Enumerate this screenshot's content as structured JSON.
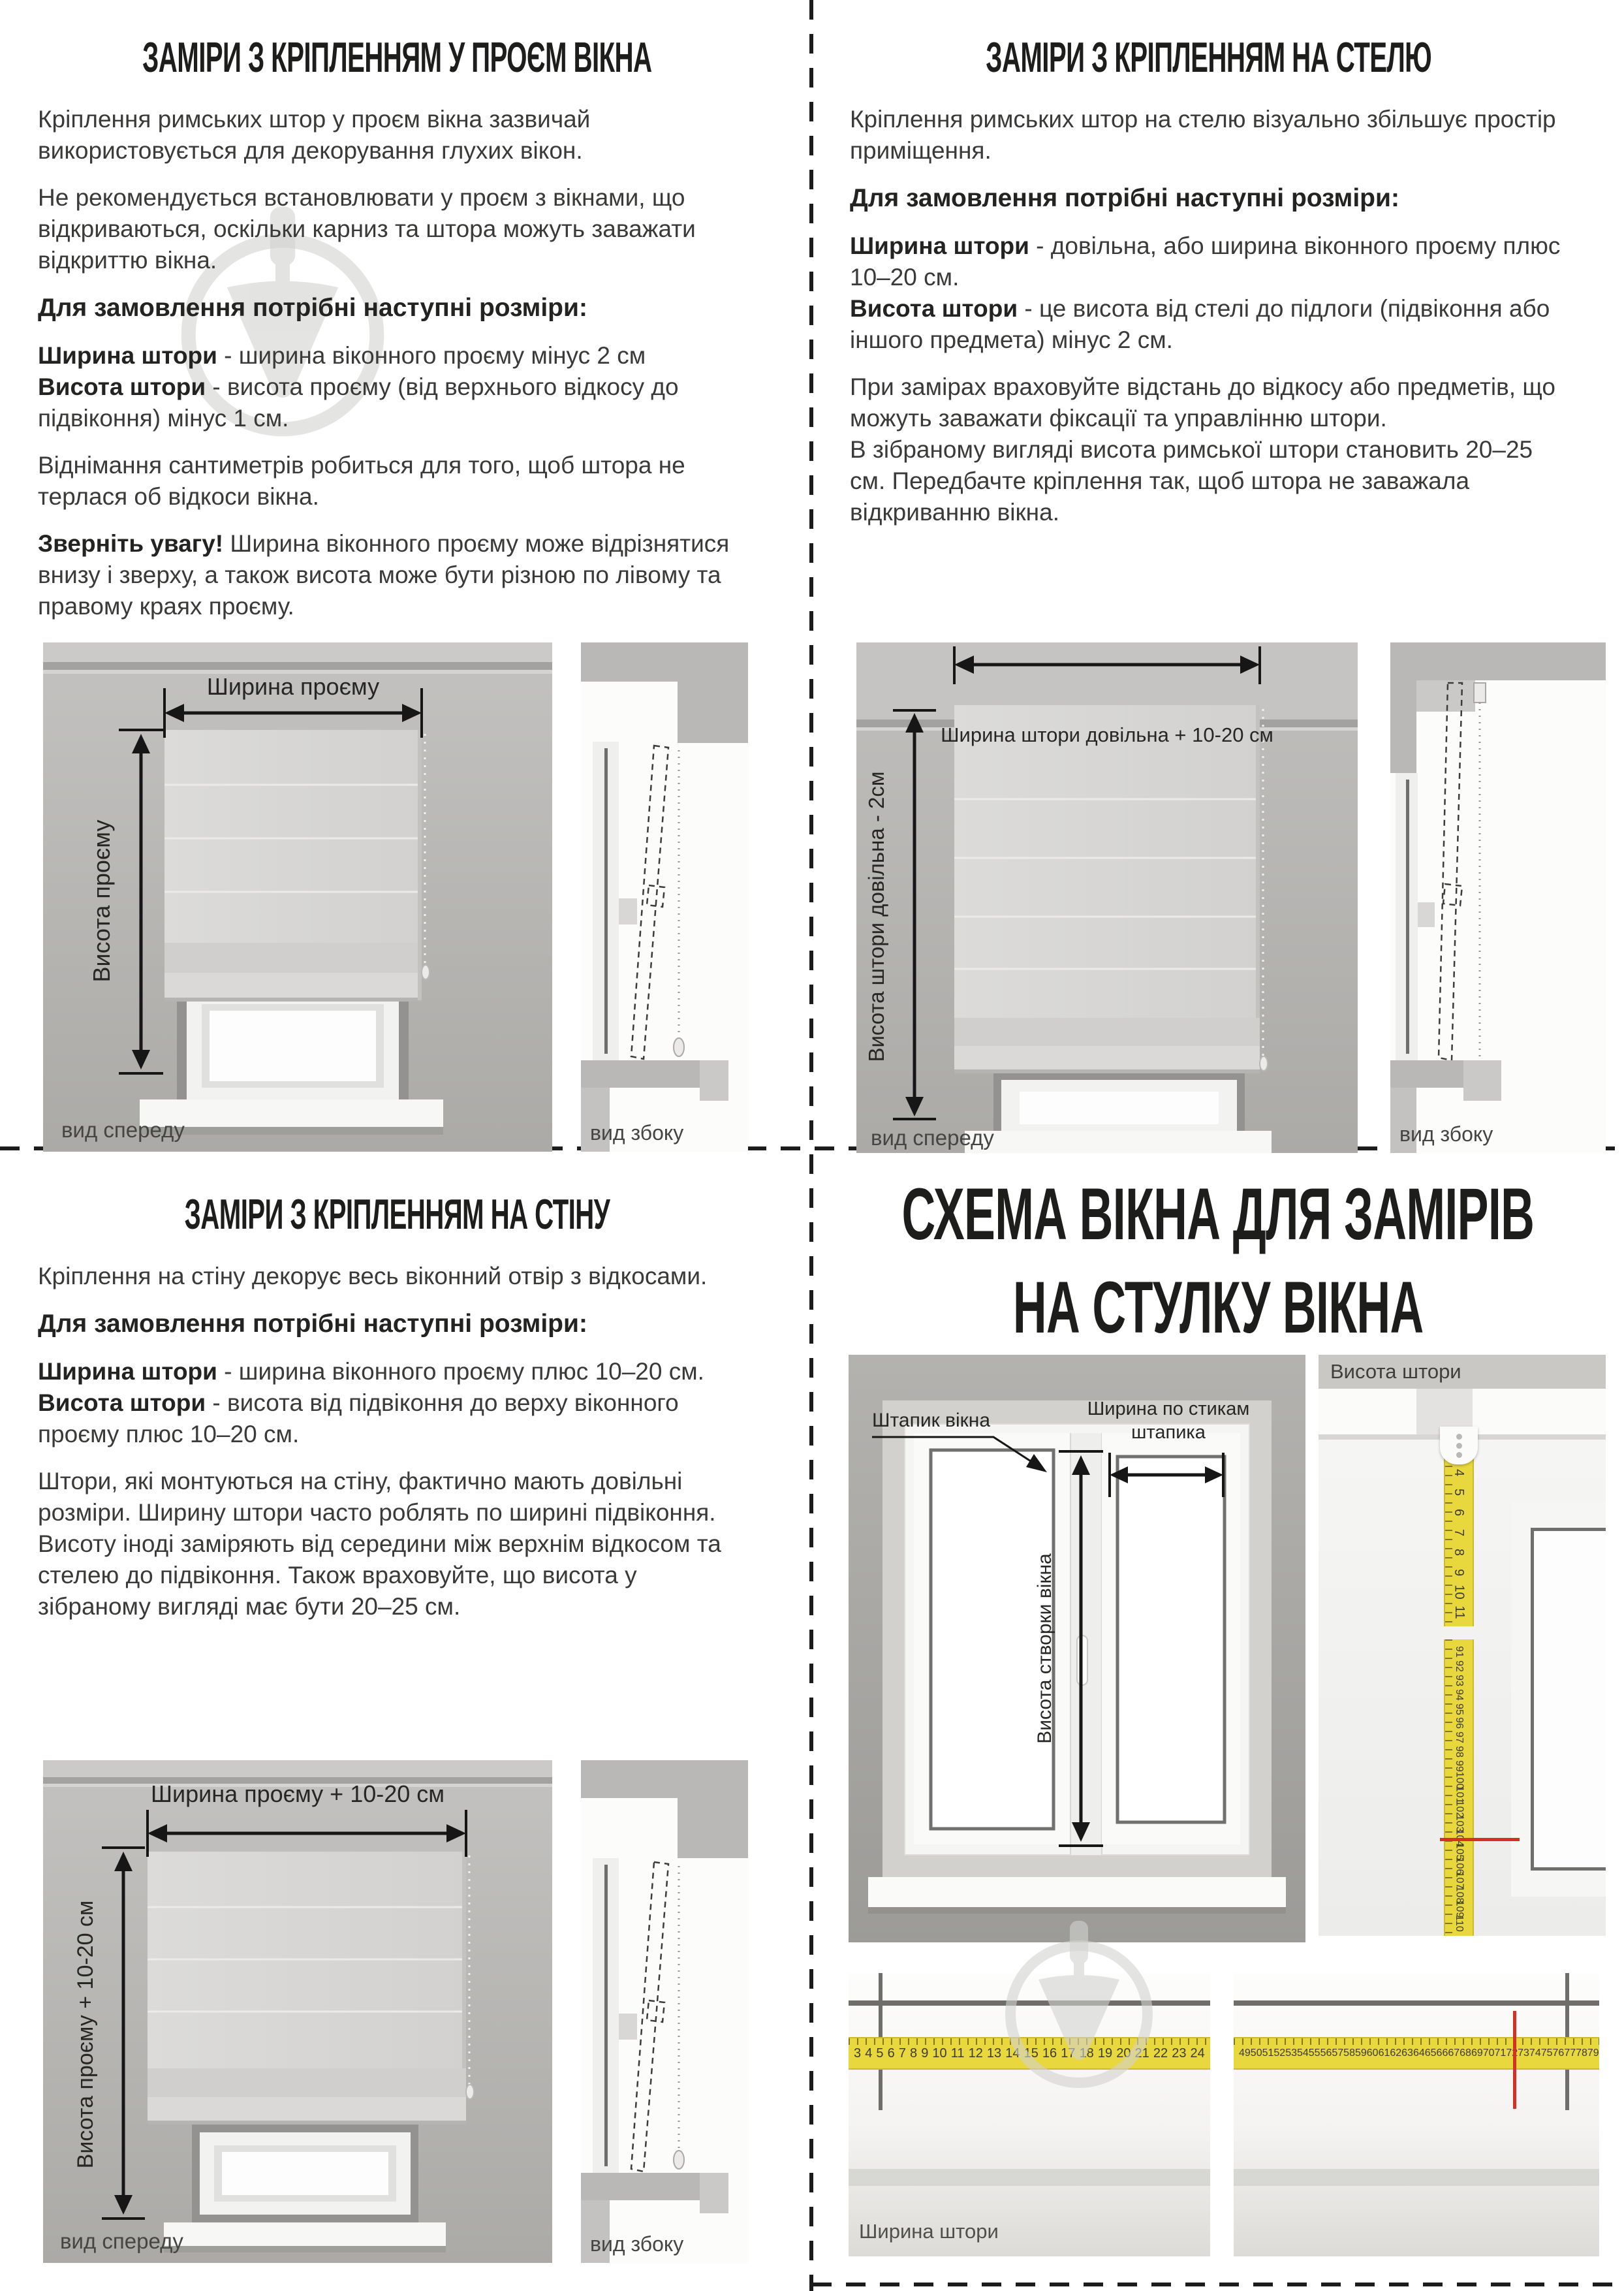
{
  "q1": {
    "title": "ЗАМІРИ З КРІПЛЕННЯМ У ПРОЄМ ВІКНА",
    "p1": "Кріплення римських штор у проєм вікна зазвичай використовується для декорування глухих вікон.",
    "p2": "Не рекомендується встановлювати у проєм з вікнами, що відкриваються, оскільки карниз та штора можуть заважати відкриттю вікна.",
    "order_heading": "Для замовлення потрібні наступні розміри:",
    "width_term": "Ширина штори",
    "width_def": " - ширина віконного проєму мінус 2 см",
    "height_term": "Висота штори",
    "height_def": " - висота проєму (від верхнього відкосу до підвіконня) мінус 1 см.",
    "p3": "Віднімання сантиметрів робиться для того, щоб штора не терлася об відкоси вікна.",
    "note_term": "Зверніть увагу!",
    "note_def": " Ширина віконного проєму може відрізнятися внизу і зверху, а також висота може бути різною по лівому та правому краях проєму.",
    "diagram": {
      "width_label": "Ширина проєму",
      "height_label": "Висота проєму",
      "front_caption": "вид спереду",
      "side_caption": "вид збоку"
    }
  },
  "q2": {
    "title": "ЗАМІРИ З КРІПЛЕННЯМ НА СТЕЛЮ",
    "p1": "Кріплення римських штор на стелю візуально збільшує простір приміщення.",
    "order_heading": "Для замовлення потрібні наступні розміри:",
    "width_term": "Ширина штори",
    "width_def": " - довільна, або ширина віконного проєму плюс 10–20 см.",
    "height_term": "Висота штори",
    "height_def": " - це висота від стелі до підлоги (підвіконня або іншого предмета) мінус 2 см.",
    "p2": "При замірах враховуйте відстань до відкосу або предметів, що можуть заважати фіксації та управлінню штори.",
    "p3": "В зібраному вигляді висота римської штори становить 20–25 см. Передбачте кріплення так, щоб штора не заважала відкриванню вікна.",
    "diagram": {
      "width_label": "Ширина штори довільна + 10-20 см",
      "height_label": "Висота штори довільна - 2см",
      "front_caption": "вид спереду",
      "side_caption": "вид збоку"
    }
  },
  "q3": {
    "title": "ЗАМІРИ З КРІПЛЕННЯМ НА СТІНУ",
    "p1": "Кріплення на стіну декорує весь віконний отвір з відкосами.",
    "order_heading": "Для замовлення потрібні наступні розміри:",
    "width_term": "Ширина штори",
    "width_def": " - ширина віконного проєму плюс 10–20 см.",
    "height_term": "Висота штори",
    "height_def": " - висота від підвіконня до верху віконного проєму плюс 10–20 см.",
    "p2": "Штори, які монтуються на стіну, фактично мають довільні розміри. Ширину штори часто роблять по ширині підвіконня. Висоту іноді заміряють від середини між верхнім відкосом та стелею до підвіконня. Також враховуйте, що висота у зібраному вигляді має бути 20–25 см.",
    "diagram": {
      "width_label": "Ширина проєму + 10-20 см",
      "height_label": "Висота проєму + 10-20 см",
      "front_caption": "вид спереду",
      "side_caption": "вид збоку"
    }
  },
  "q4": {
    "title_line1": "СХЕМА ВІКНА ДЛЯ ЗАМІРІВ",
    "title_line2": "НА СТУЛКУ ВІКНА",
    "schematic": {
      "bead_label": "Штапик вікна",
      "width_label_line1": "Ширина по стикам",
      "width_label_line2": "штапика",
      "sash_height_label": "Висота створки вікна"
    },
    "height_panel": {
      "header": "Висота штори",
      "tape_top_numbers": [
        "3",
        "4",
        "5",
        "6",
        "7",
        "8",
        "9",
        "10",
        "11"
      ],
      "tape_bottom_numbers": [
        "91",
        "92",
        "93",
        "94",
        "95",
        "96",
        "97",
        "98",
        "99",
        "100",
        "101",
        "102",
        "103",
        "104",
        "105",
        "106",
        "107",
        "108",
        "109",
        "110"
      ],
      "red_mark_value": "104"
    },
    "width_photo": {
      "caption": "Ширина штори",
      "tape_left_numbers": [
        "3",
        "4",
        "5",
        "6",
        "7",
        "8",
        "9",
        "10",
        "11",
        "12",
        "13",
        "14",
        "15",
        "16",
        "17",
        "18",
        "19",
        "20",
        "21",
        "22",
        "23",
        "24"
      ],
      "tape_right_numbers": [
        "49",
        "50",
        "51",
        "52",
        "53",
        "54",
        "55",
        "56",
        "57",
        "58",
        "59",
        "60",
        "61",
        "62",
        "63",
        "64",
        "65",
        "66",
        "67",
        "68",
        "69",
        "70",
        "71",
        "72",
        "73",
        "74",
        "75",
        "76",
        "77",
        "78",
        "79",
        "80"
      ],
      "red_mark_value": "73"
    }
  },
  "colors": {
    "tape_yellow": "#e9d83d",
    "red_mark": "#d23124",
    "wall_gray": "#b6b5b2"
  }
}
